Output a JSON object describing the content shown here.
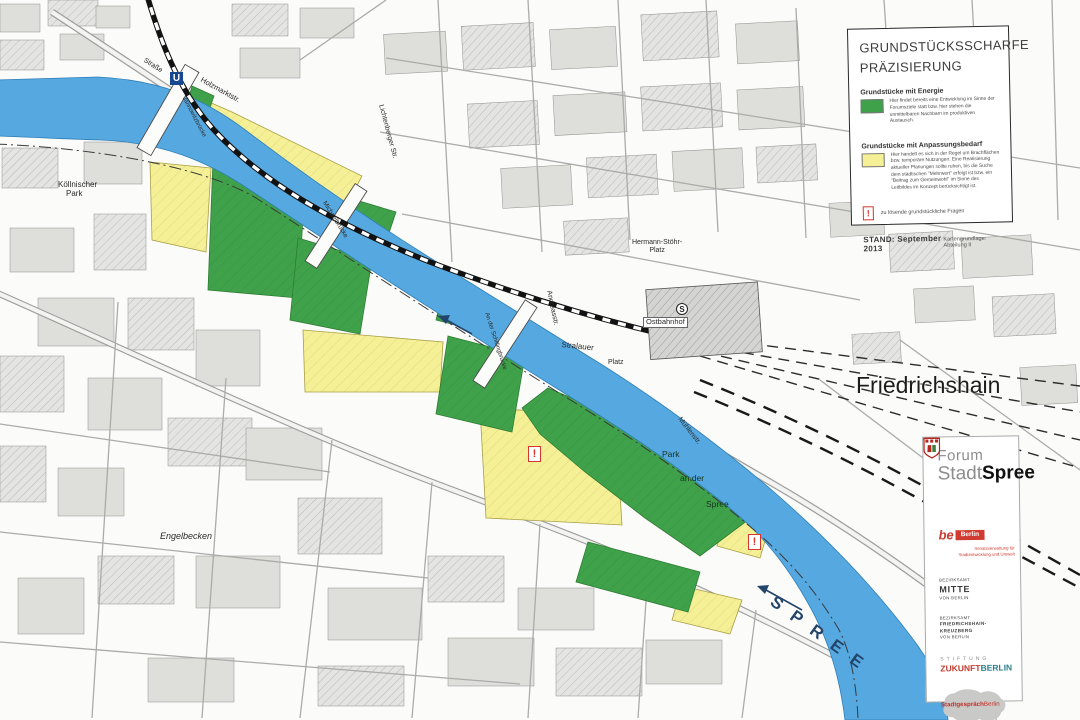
{
  "legend": {
    "title_line1": "GRUNDSTÜCKSSCHARFE",
    "title_line2": "PRÄZISIERUNG",
    "energy_heading": "Grundstücke mit Energie",
    "energy_text": "Hier findet bereits eine Entwicklung im Sinne der Forumsziele statt bzw. hier stehen die unmittelbaren Nachbarn im produktiven Austausch.",
    "adaptation_heading": "Grundstücke mit Anpassungsbedarf",
    "adaptation_text": "Hier handelt es sich in der Regel um Brachflächen bzw. temporäre Nutzungen. Eine Realisierung aktueller Planungen sollte ruhen, bis die Suche dem städtischen \"Mehrwert\" erfolgt ist bzw. ein \"Beitrag zum Gemeinwohl\" im Sinne des Leitbildes im Konzept berücksichtigt ist.",
    "issue_symbol": "!",
    "issue_text": "zu lösende grundstückliche Fragen",
    "stand": "STAND: September 2013",
    "source": "Kartengrundlage: Abteilung II"
  },
  "map_labels": {
    "district": "Friedrichshain",
    "river": "SPREE",
    "engelbecken": "Engelbecken",
    "koellnischer_1": "Köllnischer",
    "koellnischer_2": "Park",
    "ostbahnhof": "Ostbahnhof",
    "hermann_1": "Hermann-Stöhr-",
    "hermann_2": "Platz",
    "stralauer": "Stralauer",
    "platz": "Platz",
    "strasse": "Straße",
    "holzmarkt": "Holzmarktstr.",
    "jannowitzbruecke": "Jannowitzbrücke",
    "michaelbruecke": "Michaelbrücke",
    "schillingbruecke": "An der Schillingbrücke",
    "andreasstrasse": "Andreasstr.",
    "muehlenstrasse": "Mühlenstr.",
    "lichtenberger": "Lichtenberger Str.",
    "warschauer": "Warschauer Str.",
    "park_1": "Park",
    "park_2": "an der",
    "park_3": "Spree",
    "ubahn": "U",
    "sbahn": "S",
    "issue_marker": "!"
  },
  "forum_panel": {
    "title_forum": "Forum",
    "title_stadt": "Stadt",
    "title_spree": "Spree",
    "be_berlin": {
      "be": "be",
      "berlin": "Berlin",
      "sub": "Senatsverwaltung für Stadtentwicklung und Umwelt"
    },
    "mitte": {
      "line1": "BEZIRKSAMT",
      "line2": "MITTE",
      "line3": "VON BERLIN"
    },
    "friedrichshain_kreuzberg": {
      "line1": "BEZIRKSAMT",
      "line2": "FRIEDRICHSHAIN-",
      "line3": "KREUZBERG",
      "line4": "VON BERLIN"
    },
    "stiftung": {
      "line1": "STIFTUNG",
      "word1": "ZUKUNFT",
      "word2": "BERLIN"
    },
    "stadtgespraech": {
      "word1": "Stadtgespräch",
      "word2": "Berlin"
    }
  },
  "colors": {
    "parcel_energy_green": "#3fa24b",
    "parcel_adaptation_yellow": "#f5f096",
    "river_blue": "#55a8e0",
    "alert_red": "#d6352b",
    "be_berlin_red": "#cf3b30",
    "zukunft_red": "#c23a2f",
    "zukunft_teal": "#2c7f8e",
    "spree_label_navy": "#24456b"
  }
}
